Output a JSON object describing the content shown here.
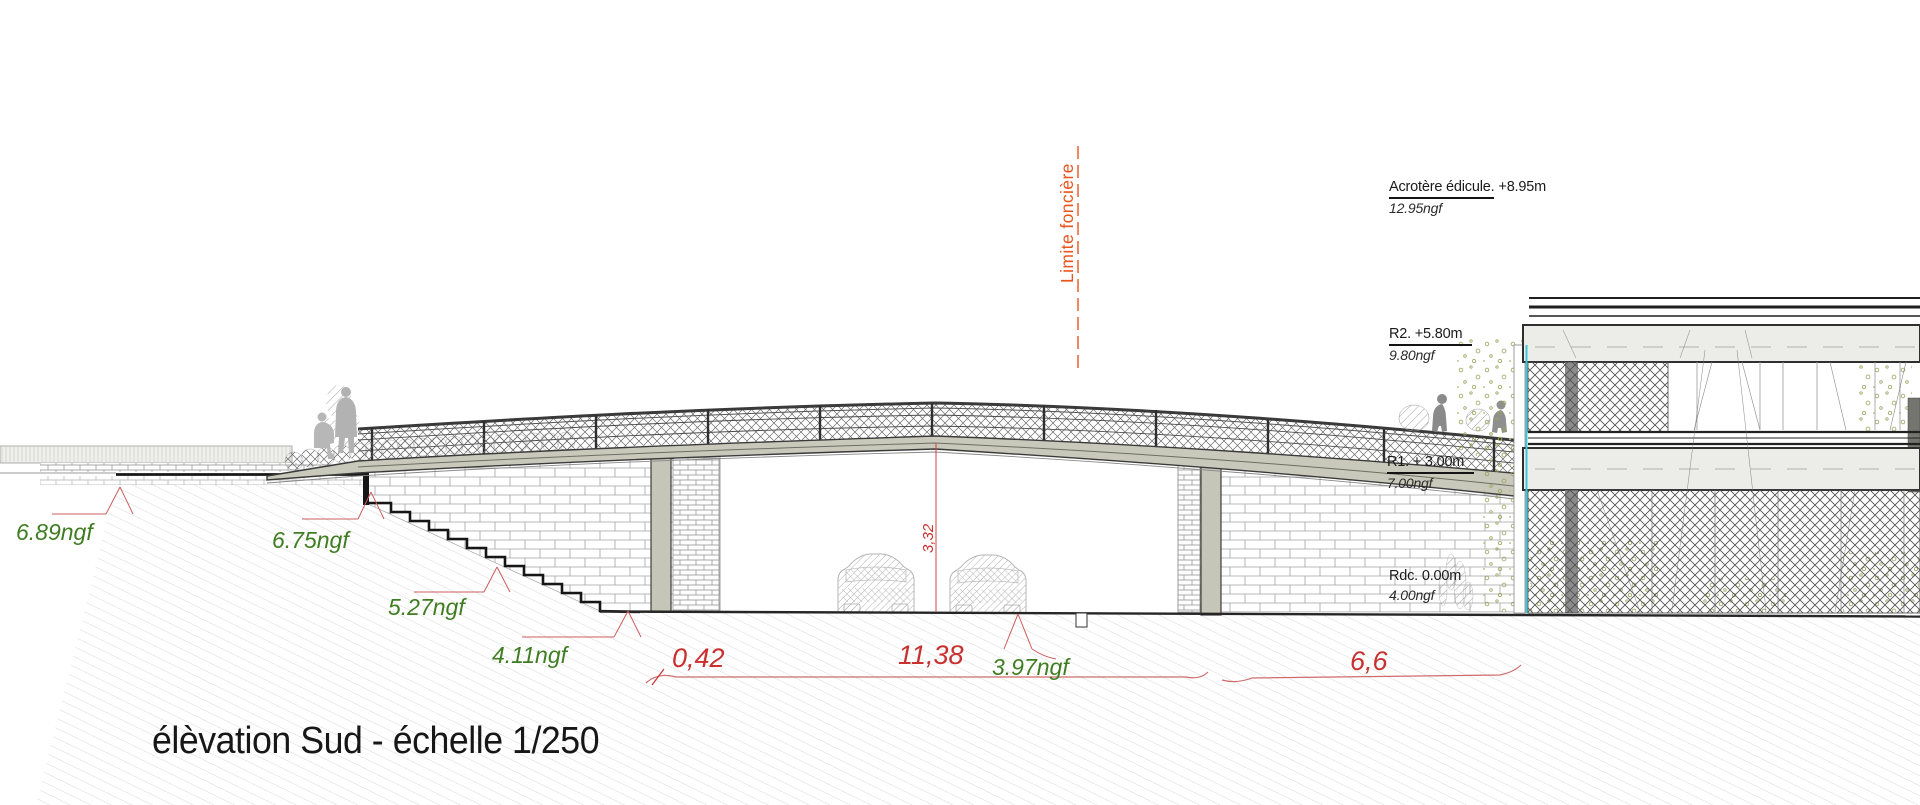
{
  "title": "élèvation Sud - échelle 1/250",
  "property_line": {
    "label": "Limite foncière"
  },
  "levels": [
    {
      "label_main": "Acrotère édicule.",
      "label_value": "+8.95m",
      "ngf": "12.95ngf"
    },
    {
      "label_main": "R2. +5.80m",
      "label_value": "",
      "ngf": "9.80ngf"
    },
    {
      "label_main": "R1. + 3.00m",
      "label_value": "",
      "ngf": "7.00ngf"
    },
    {
      "label_main": "Rdc. 0.00m",
      "label_value": "",
      "ngf": "4.00ngf"
    }
  ],
  "ground_elevations": [
    {
      "label": "6.89ngf"
    },
    {
      "label": "6.75ngf"
    },
    {
      "label": "5.27ngf"
    },
    {
      "label": "4.11ngf"
    },
    {
      "label": "3.97ngf"
    }
  ],
  "dimensions": {
    "d1": "0,42",
    "d2": "11,38",
    "d3": "6,6",
    "clearance": "3,32"
  },
  "colors": {
    "elevation_green": "#3f7d22",
    "dimension_red": "#c93030",
    "property_line_orange": "#e8561e",
    "deck_beige": "#c9c9bb",
    "facade_cyan": "#3fc6d4"
  }
}
